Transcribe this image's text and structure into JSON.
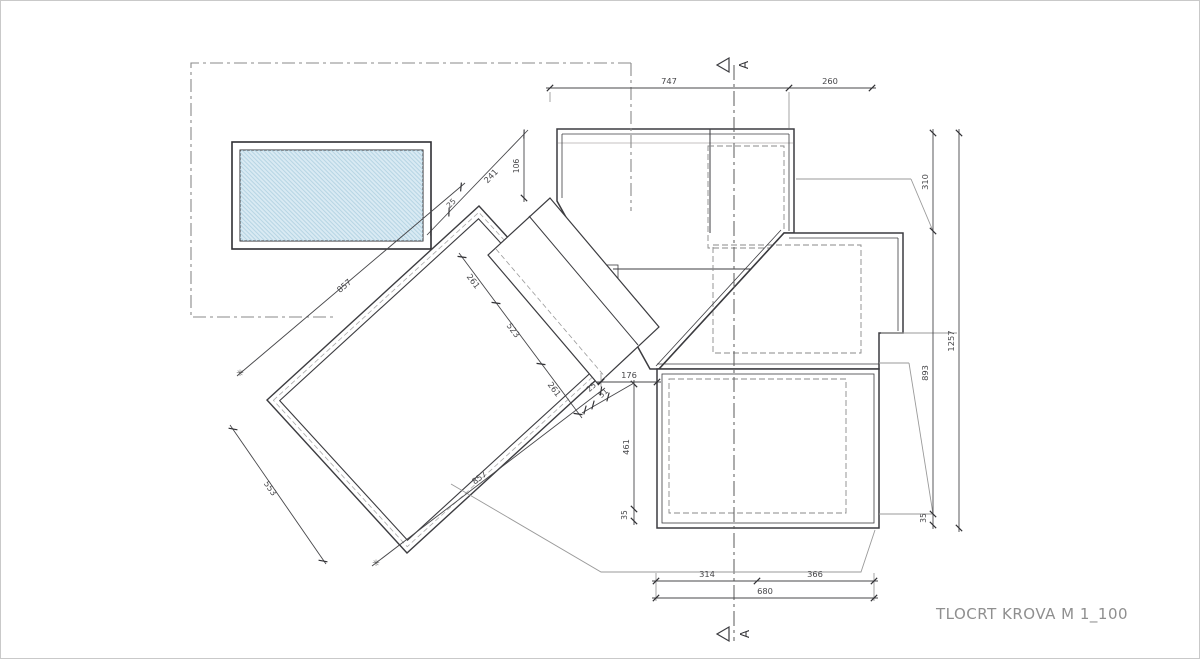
{
  "title": "TLOCRT KROVA  M 1_100",
  "section_markers": {
    "top": "A",
    "bottom": "A"
  },
  "dims": {
    "top": [
      "747",
      "260"
    ],
    "right_inner": [
      "310",
      "893",
      "35"
    ],
    "right_outer": [
      "1257"
    ],
    "bottom": [
      "314",
      "366"
    ],
    "bottom_overall": [
      "680"
    ],
    "left_vertical": [
      "461",
      "35"
    ],
    "center": [
      "176"
    ],
    "entry": [
      "25",
      "51"
    ],
    "upper_diag": [
      "25",
      "241"
    ],
    "upper_vert": [
      "106"
    ],
    "mid_diag": [
      "261",
      "523",
      "261"
    ],
    "terrace_top": [
      "857"
    ],
    "terrace_left": [
      "553"
    ],
    "terrace_bottom": [
      "857"
    ],
    "asterisk": "✳"
  },
  "colors": {
    "line_dark": "#3c3c40",
    "hatch_gray": "#a49e99",
    "hatch_red": "#9a5f54",
    "pool_fill": "#d9eaf3",
    "pool_hatch": "#aecfe0",
    "dim": "#47474a",
    "muted": "#9a9a9a",
    "title": "#8f8f8f"
  }
}
